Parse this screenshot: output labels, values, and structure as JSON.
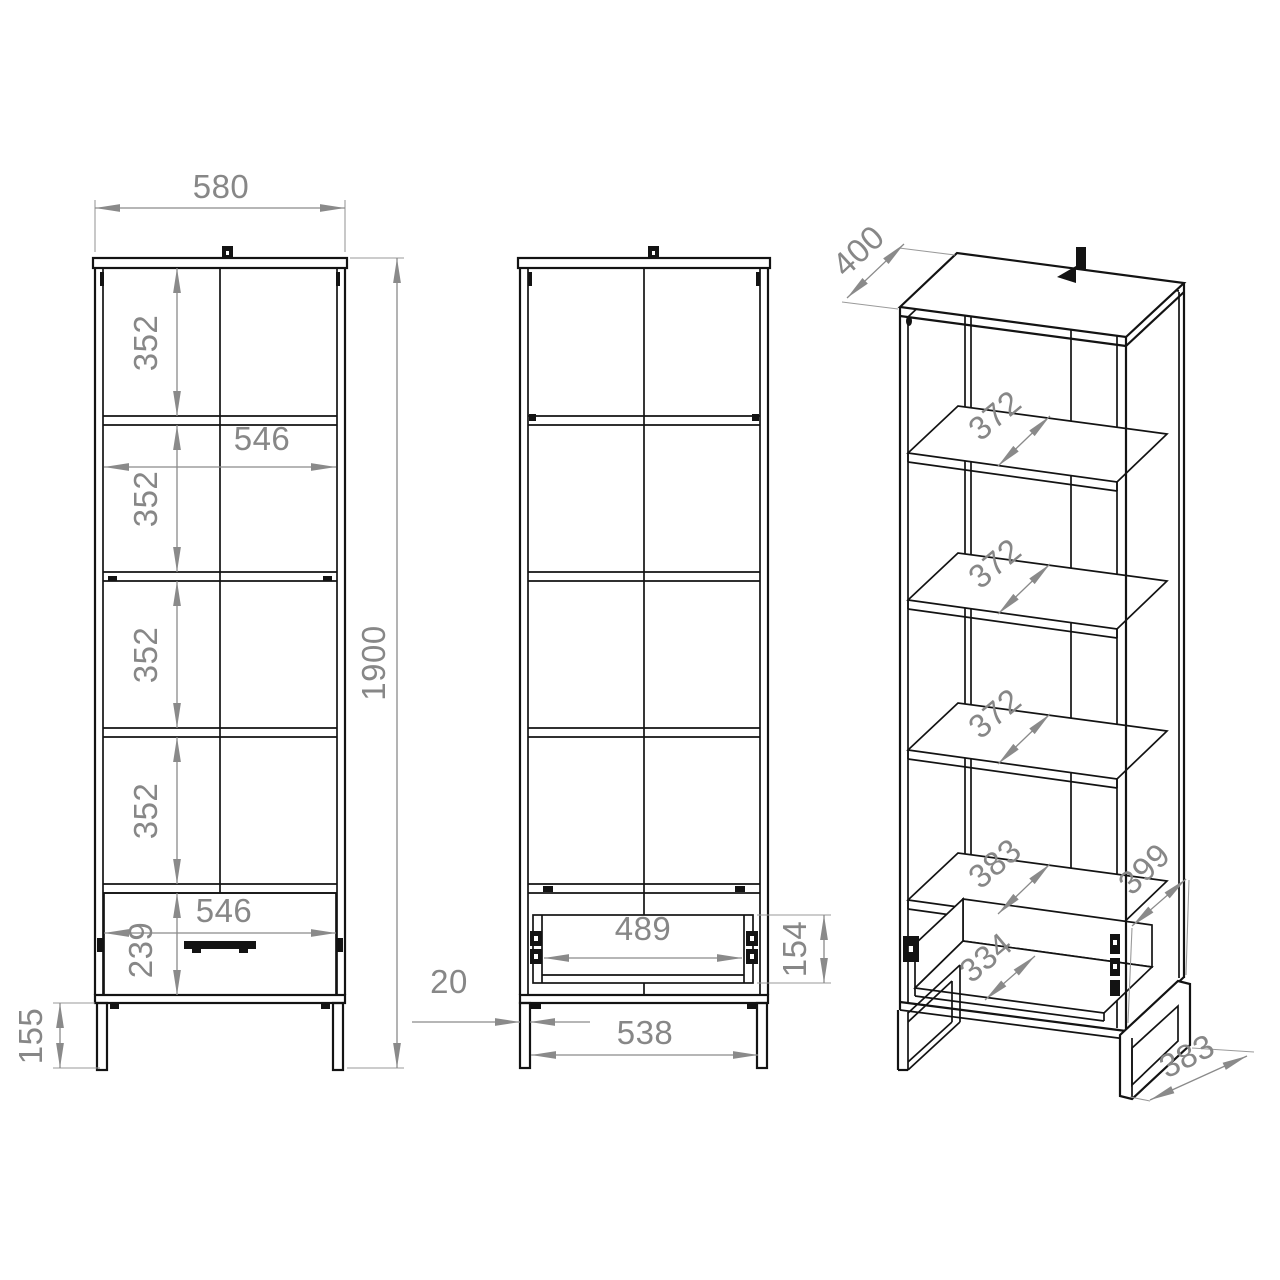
{
  "drawing": {
    "kind": "furniture technical drawing",
    "subject": "tall bookcase with bottom drawer, three views",
    "background": "#ffffff",
    "line_color": "#131313",
    "dim_color": "#878787"
  },
  "dims": {
    "front": {
      "width": "580",
      "height": "1900",
      "gap1": "352",
      "gap2": "352",
      "gap3": "352",
      "gap4": "352",
      "inner_width": "546",
      "drawer_width": "546",
      "drawer_front": "239",
      "leg_height": "155"
    },
    "back": {
      "drawer_inner_width": "489",
      "drawer_height": "154",
      "leg_thickness": "20",
      "leg_span": "538"
    },
    "iso": {
      "top_depth": "400",
      "shelf1": "372",
      "shelf2": "372",
      "shelf3": "372",
      "shelf4": "383",
      "drawer_depth": "334",
      "side_depth": "399",
      "base_depth": "383"
    }
  }
}
